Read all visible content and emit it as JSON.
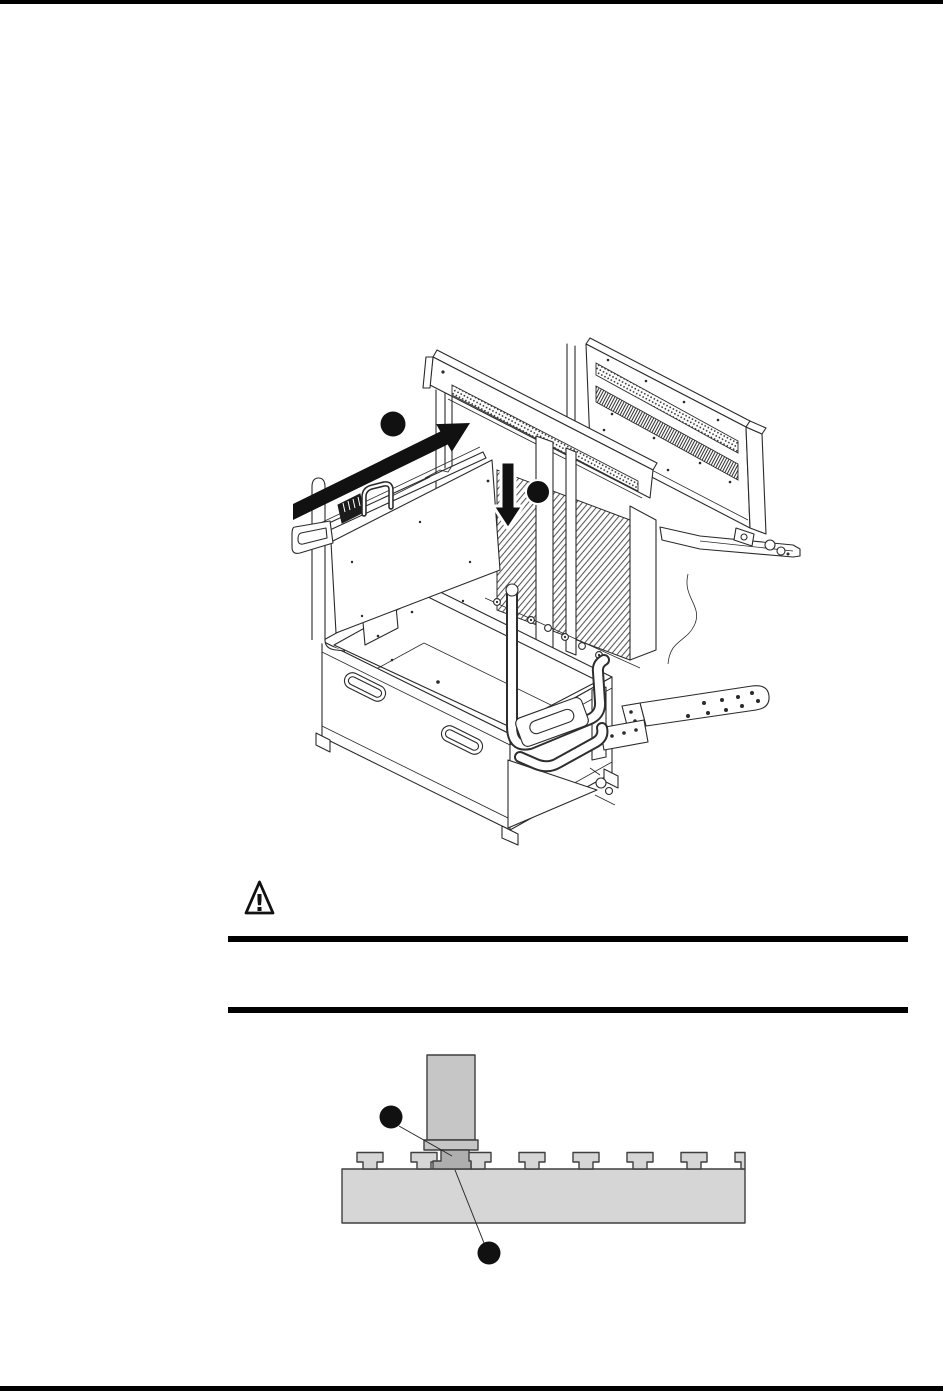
{
  "page": {
    "background": "#ffffff",
    "top_edge_bar_color": "#000000",
    "bottom_edge_bar_color": "#000000"
  },
  "colors": {
    "line_art": "#2a2a2a",
    "callout_marker": "#111111",
    "direction_arrow": "#111111",
    "caution_rule": "#000000",
    "slot_base_fill": "#d6d6d6",
    "foot_fill": "#c6c6c6",
    "foot_pad_fill": "#aeaeae"
  },
  "figure_assembly": {
    "name": "module-installation-isometric-diagram",
    "description": "Isometric line drawing: sliding a module into an open transport case with rear panel",
    "callouts": [
      {
        "id": 1,
        "label": "",
        "marker": "filled-circle"
      },
      {
        "id": 2,
        "label": "",
        "marker": "filled-circle"
      }
    ],
    "arrows": [
      {
        "id": 1,
        "direction": "up-right",
        "meaning": "slide-module-in"
      },
      {
        "id": 2,
        "direction": "down",
        "meaning": "lower-into-place"
      }
    ]
  },
  "caution": {
    "icon": "warning-triangle-icon",
    "glyph": "!",
    "body_text": ""
  },
  "figure_foot_slot": {
    "name": "foot-in-t-slot-cross-section",
    "description": "Cross-section of a foot engaging a T-slot base plate",
    "callouts": [
      {
        "id": 1,
        "label": "",
        "marker": "filled-circle"
      },
      {
        "id": 2,
        "label": "",
        "marker": "filled-circle"
      }
    ]
  }
}
